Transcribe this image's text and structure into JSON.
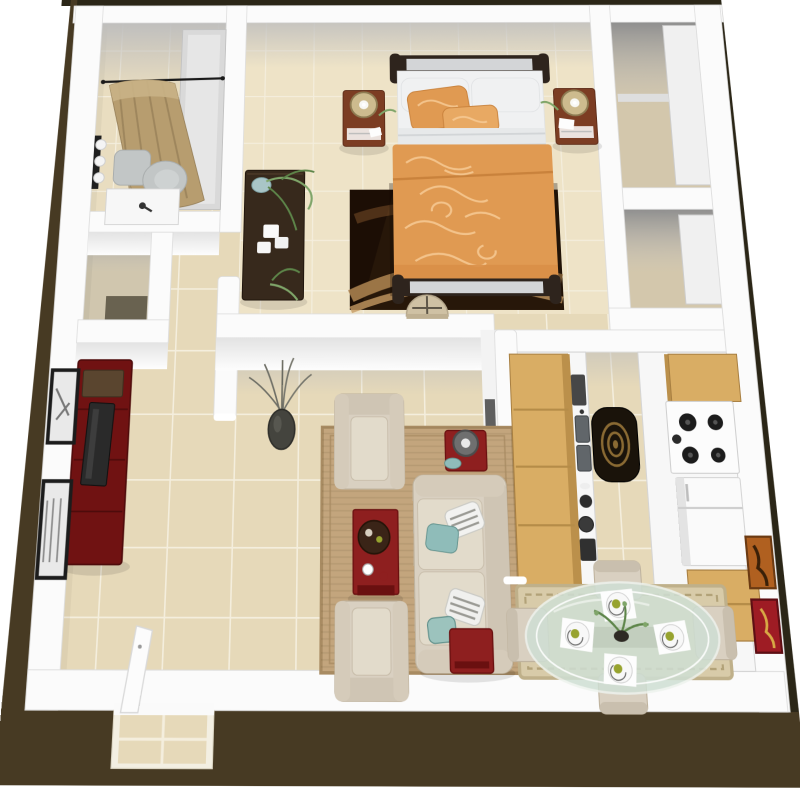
{
  "page": {
    "title": "3D top-down floor plan rendering of a one-bedroom apartment",
    "background": "#ffffff"
  },
  "colors": {
    "outer": "#473a23",
    "outerDark": "#2b2617",
    "wall": "#fbfbfb",
    "wallEdge": "#dcdcdc",
    "floor": "#e6d9b9",
    "floorBed": "#eee3c7",
    "floorBath": "#e9ddc0",
    "floorCloset": "#d3c7ac",
    "grout": "#f4eedd",
    "red": "#8e1f1f",
    "redDark": "#6a1010",
    "wood": "#d9ad64",
    "woodShade": "#bb904b",
    "beige": "#d9d0c1",
    "beigeShade": "#bfb39e",
    "teal": "#8fbcb9",
    "espresso": "#37291c",
    "bedFrame": "#2e241d",
    "panel": "#d3d5d7",
    "pillow": "#f0f1f2",
    "sheet": "#e7e9ea",
    "comforter": "#e09a52",
    "comforterLight": "#f5c891",
    "nightstand": "#7c3d23",
    "lamp": "#cdbb8e",
    "lampEdge": "#8d7b52",
    "toilet": "#c2c6c6",
    "toiletDark": "#a9adad",
    "curtain": "#b79d6f",
    "curtainStripe": "#937c55",
    "tub": "#d9d9d9",
    "fridge": "#fafafa",
    "plant": "#7fa569",
    "plantDark": "#5d8549",
    "rugLiving": "#c3a57d",
    "rugBorder": "#a88b62",
    "rugBed": "#271709",
    "rugBedPattern": "#a97f4e",
    "rugKitchen": "#1a130a",
    "spiral": "#8a6a33",
    "diningRug": "#d8cba9",
    "diningRugBorder": "#bfb08a",
    "glass": "#cfdfd4",
    "plate": "#f8f8f8",
    "apple": "#97a32f",
    "artOrange": "#b06020",
    "artRed": "#9e1c24",
    "frame": "#1c1c1c",
    "tv": "#2a2a2a"
  },
  "floorplan": {
    "view": "3d-top-down-perspective",
    "rooms": [
      {
        "name": "bathroom",
        "items": [
          "shower-curtain",
          "curtain-rod",
          "bathtub",
          "toilet",
          "vanity-sink",
          "wall-light-bar"
        ]
      },
      {
        "name": "bedroom",
        "items": [
          "sleigh-bed",
          "orange-comforter",
          "accent-pillows",
          "nightstand-left",
          "nightstand-right",
          "drum-lamp-left",
          "drum-lamp-right",
          "espresso-dresser",
          "trailing-plant",
          "dark-area-rug",
          "demilune-table"
        ]
      },
      {
        "name": "closet-top",
        "items": [
          "shelving"
        ]
      },
      {
        "name": "closet-bottom",
        "items": [
          "shelving"
        ]
      },
      {
        "name": "hallway",
        "items": [
          "storage-closet",
          "floor-vase-with-twigs"
        ]
      },
      {
        "name": "living-room",
        "items": [
          "sofa",
          "armchair-north",
          "armchair-south",
          "teal-accent-pillows",
          "striped-pillows",
          "red-coffee-table",
          "red-side-table-with-lamp",
          "red-accent-stool",
          "sisal-area-rug",
          "red-tv-console",
          "flat-tv",
          "framed-art-west-1",
          "framed-art-west-2"
        ]
      },
      {
        "name": "kitchen",
        "items": [
          "upper-cabinets-west",
          "counter-with-double-sink",
          "dish-stack",
          "upper-cabinets-east",
          "range-stove",
          "refrigerator",
          "base-cabinet",
          "black-spiral-rug"
        ]
      },
      {
        "name": "dining-area",
        "items": [
          "oval-glass-table",
          "place-setting-north",
          "place-setting-west",
          "place-setting-east",
          "place-setting-south",
          "plant-centerpiece",
          "dining-chair-north",
          "dining-chair-west",
          "dining-chair-east",
          "dining-chair-south",
          "beige-rug",
          "framed-art-orange",
          "framed-art-red"
        ]
      },
      {
        "name": "entry",
        "items": [
          "open-front-door",
          "door-threshold"
        ]
      }
    ]
  }
}
